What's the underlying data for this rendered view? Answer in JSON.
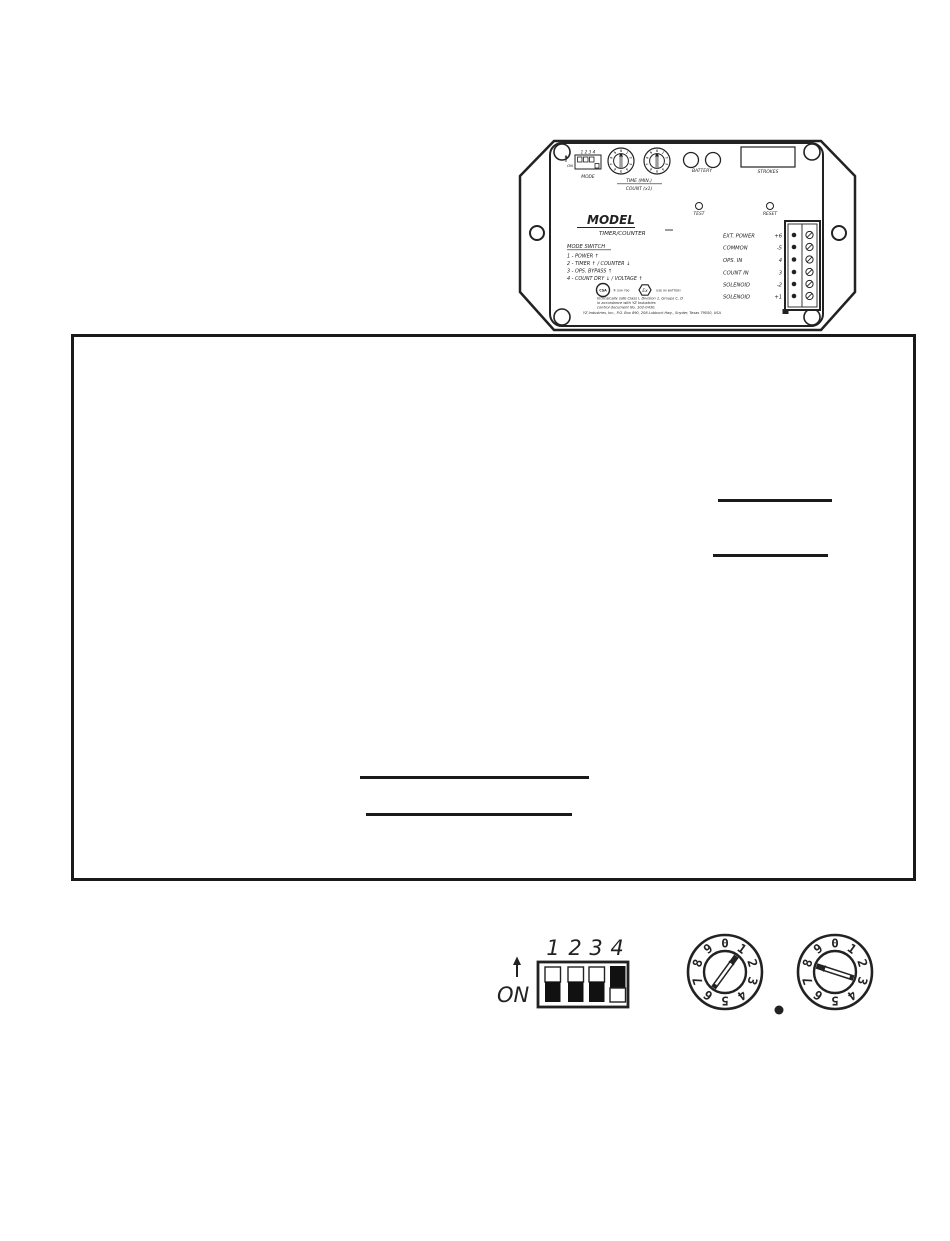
{
  "device": {
    "dip_numbers": "1 2 3 4",
    "on_label": "ON",
    "mode_label": "MODE",
    "time_label": "TIME  (MIN.)",
    "count_label": "COUNT  (x1)",
    "battery_label": "BATTERY",
    "strokes_label": "STROKES",
    "test_label": "TEST",
    "reset_label": "RESET",
    "model_label": "MODEL",
    "model_type": "TIMER/COUNTER",
    "mode_switch_title": "MODE SWITCH",
    "mode_switch_items": [
      "1  -  POWER ↑",
      "2  -  TIMER ↑  /  COUNTER ↓",
      "3  -  OPS. BYPASS ↑",
      "4  -  COUNT DRY ↓  /  VOLTAGE ↑"
    ],
    "terminals": [
      {
        "label": "EXT. POWER",
        "num": "+6"
      },
      {
        "label": "COMMON",
        "num": "-5"
      },
      {
        "label": "OPS. IN",
        "num": "4"
      },
      {
        "label": "COUNT IN",
        "num": "3"
      },
      {
        "label": "SOLENOID",
        "num": "-2"
      },
      {
        "label": "SOLENOID",
        "num": "+1"
      }
    ],
    "csa_mark": "CSA",
    "csa_text": "® SVA 790",
    "ex_mark": "Ex",
    "ex_text": "USE 9V BATTERY",
    "intrinsic_line1": "Intrinsically safe Class I, Division 1, Groups C, D",
    "intrinsic_line2": "in accordance with YZ Industries",
    "intrinsic_line3": "control document No. 102-0430.",
    "address": "YZ Industries, Inc., P.O. Box 890, 208 Lubbock Hwy., Snyder, Texas 79550, USA"
  },
  "bottom_panel": {
    "dip_labels": [
      "1",
      "2",
      "3",
      "4"
    ],
    "on_label": "ON",
    "dip_states": [
      "off",
      "off",
      "off",
      "on"
    ],
    "dial_digits": [
      "0",
      "1",
      "2",
      "3",
      "4",
      "5",
      "6",
      "7",
      "8",
      "9"
    ],
    "left_dial_value": 1,
    "right_dial_value": 8
  },
  "colors": {
    "ink": "#222222"
  }
}
